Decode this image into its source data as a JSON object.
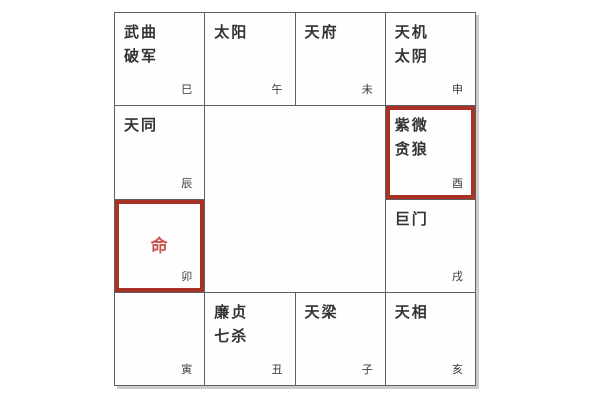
{
  "palette": {
    "background": "#ffffff",
    "grid_line": "#606060",
    "star_text": "#333333",
    "branch_text": "#3a3a3a",
    "highlight_border": "#a93226",
    "ming_text": "#c9554e",
    "shadow": "#cccccc"
  },
  "chart": {
    "type": "ziwei-doushu-palace-grid",
    "cells": [
      {
        "stars": "武曲\n破军",
        "branch": "巳",
        "highlighted": false,
        "ming": ""
      },
      {
        "stars": "太阳",
        "branch": "午",
        "highlighted": false,
        "ming": ""
      },
      {
        "stars": "天府",
        "branch": "未",
        "highlighted": false,
        "ming": ""
      },
      {
        "stars": "天机\n太阴",
        "branch": "申",
        "highlighted": false,
        "ming": ""
      },
      {
        "stars": "天同",
        "branch": "辰",
        "highlighted": false,
        "ming": ""
      },
      {
        "stars": "紫微\n贪狼",
        "branch": "酉",
        "highlighted": true,
        "ming": ""
      },
      {
        "stars": "",
        "branch": "卯",
        "highlighted": true,
        "ming": "命"
      },
      {
        "stars": "巨门",
        "branch": "戌",
        "highlighted": false,
        "ming": ""
      },
      {
        "stars": "",
        "branch": "寅",
        "highlighted": false,
        "ming": ""
      },
      {
        "stars": "廉贞\n七杀",
        "branch": "丑",
        "highlighted": false,
        "ming": ""
      },
      {
        "stars": "天梁",
        "branch": "子",
        "highlighted": false,
        "ming": ""
      },
      {
        "stars": "天相",
        "branch": "亥",
        "highlighted": false,
        "ming": ""
      }
    ]
  }
}
